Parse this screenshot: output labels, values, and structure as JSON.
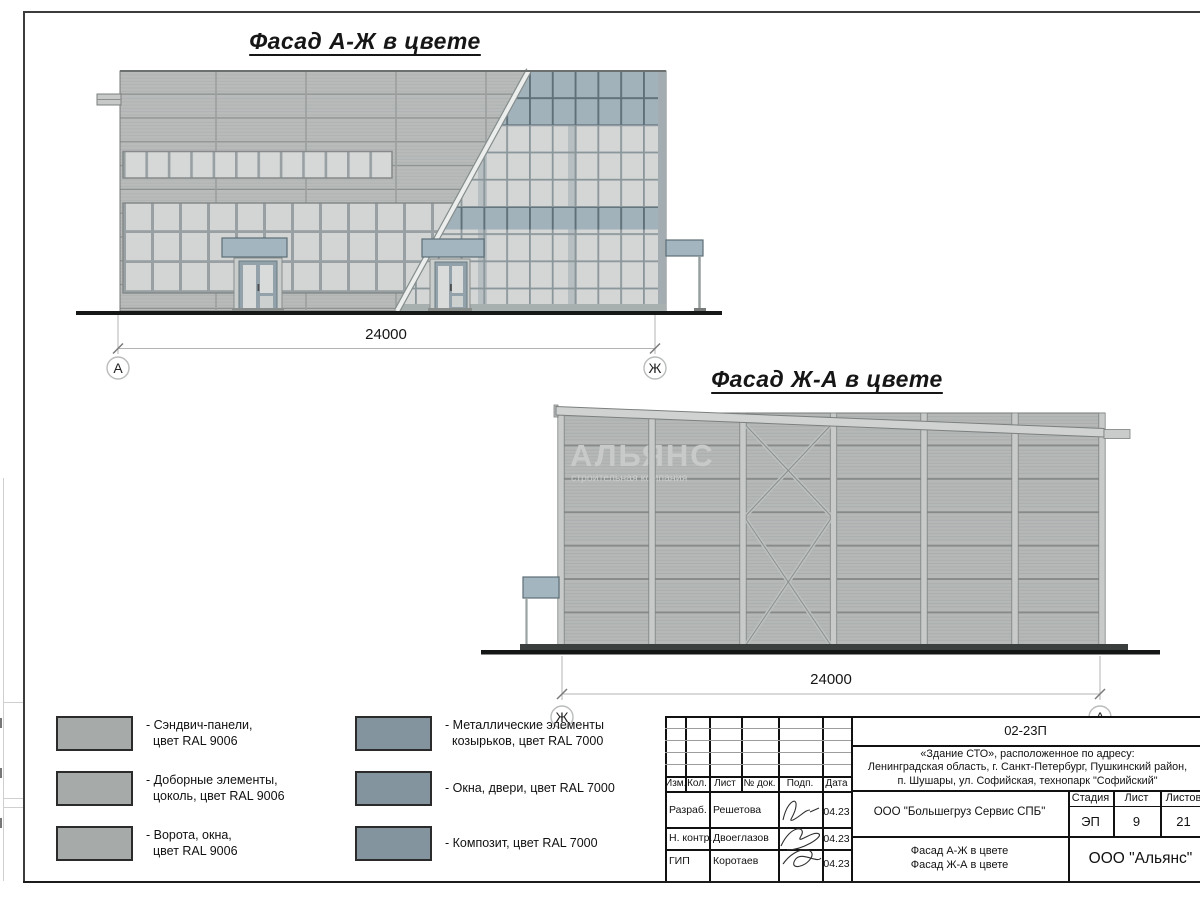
{
  "facade1": {
    "title": "Фасад А-Ж в цвете",
    "dimension": "24000",
    "axis_left": "А",
    "axis_right": "Ж"
  },
  "facade2": {
    "title": "Фасад Ж-А в цвете",
    "dimension": "24000",
    "axis_left": "Ж",
    "axis_right": "А",
    "watermark_line1": "АЛЬЯНС",
    "watermark_line2": "строительная компания"
  },
  "legend": {
    "items": [
      {
        "line1": "- Сэндвич-панели,",
        "line2": "цвет RAL 9006",
        "color": "#a6aaa9",
        "swatch_style": "background:#a6aaa9"
      },
      {
        "line1": "- Доборные элементы,",
        "line2": "цоколь, цвет RAL 9006",
        "color": "#a6aaa9",
        "swatch_style": "background:#a6aaa9"
      },
      {
        "line1": "- Ворота, окна,",
        "line2": "цвет RAL 9006",
        "color": "#a6aaa9",
        "swatch_style": "background:#a6aaa9"
      },
      {
        "line1": "- Металлические элементы",
        "line2": "козырьков, цвет RAL 7000",
        "color": "#84949e",
        "swatch_style": "background:#84949e"
      },
      {
        "line1": "- Окна, двери, цвет RAL 7000",
        "line2": "",
        "color": "#84949e",
        "swatch_style": "background:#84949e"
      },
      {
        "line1": "- Композит, цвет RAL 7000",
        "line2": "",
        "color": "#84949e",
        "swatch_style": "background:#84949e"
      }
    ]
  },
  "title_block": {
    "doc_number": "02-23П",
    "project_line1": "«Здание СТО», расположенное по адресу:",
    "project_line2": "Ленинградская область, г. Санкт-Петербург, Пушкинский район,",
    "project_line3": "п. Шушары, ул. Софийская, технопарк \"Софийский\"",
    "client": "ООО \"Большегруз Сервис СПБ\"",
    "stage_label": "Стадия",
    "sheet_label": "Лист",
    "sheets_label": "Листов",
    "stage": "ЭП",
    "sheet_no": "9",
    "sheets_total": "21",
    "sheet_title_line1": "Фасад А-Ж в цвете",
    "sheet_title_line2": "Фасад Ж-А в цвете",
    "company": "ООО \"Альянс\"",
    "col_izm": "Изм.",
    "col_kol": "Кол.",
    "col_list": "Лист",
    "col_doc": "№ док.",
    "col_podp": "Подп.",
    "col_data": "Дата",
    "rows": [
      {
        "role": "Разраб.",
        "name": "Решетова",
        "date": "04.23"
      },
      {
        "role": "Н. контр.",
        "name": "Двоеглазов",
        "date": "04.23"
      },
      {
        "role": "ГИП",
        "name": "Коротаев",
        "date": "04.23"
      }
    ]
  },
  "colors": {
    "ral9006_panels": "#b8bbba",
    "ral9006_swatch": "#a6aaa9",
    "ral7000_swatch": "#84949e",
    "ral7000_composite": "#a2b2bb",
    "canopy": "#a3b6c0",
    "glass": "#d3d6d5",
    "ground_line": "#161817"
  }
}
